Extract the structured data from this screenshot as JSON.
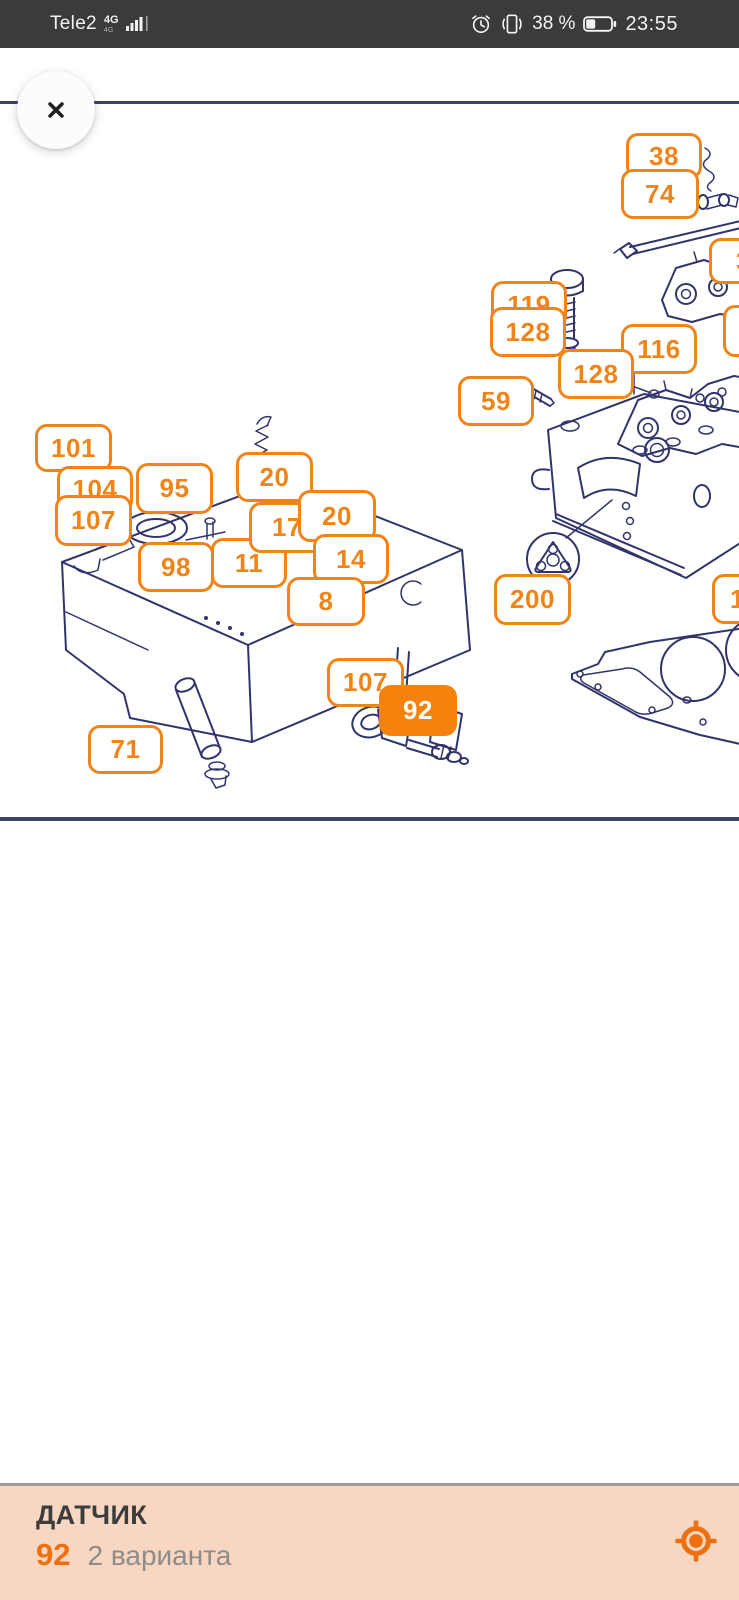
{
  "status_bar": {
    "carrier": "Tele2",
    "network": "4G",
    "network_sub": "4G",
    "battery_percent": "38 %",
    "battery_level": 0.38,
    "time": "23:55"
  },
  "diagram": {
    "accent": "#F08418",
    "highlight_fill": "#F5820D",
    "line_color": "#31346B",
    "labels": [
      {
        "text": "38",
        "x": 626,
        "y": 133,
        "w": 76,
        "h": 46
      },
      {
        "text": "74",
        "x": 621,
        "y": 169,
        "w": 78,
        "h": 50
      },
      {
        "text": "119",
        "x": 491,
        "y": 281,
        "w": 76,
        "h": 48
      },
      {
        "text": "128",
        "x": 490,
        "y": 307,
        "w": 76,
        "h": 50
      },
      {
        "text": "116",
        "x": 621,
        "y": 324,
        "w": 76,
        "h": 50
      },
      {
        "text": "128",
        "x": 558,
        "y": 349,
        "w": 76,
        "h": 50
      },
      {
        "text": "59",
        "x": 458,
        "y": 376,
        "w": 76,
        "h": 50
      },
      {
        "text": "101",
        "x": 35,
        "y": 424,
        "w": 77,
        "h": 48
      },
      {
        "text": "104",
        "x": 57,
        "y": 466,
        "w": 76,
        "h": 47
      },
      {
        "text": "107",
        "x": 55,
        "y": 495,
        "w": 77,
        "h": 51
      },
      {
        "text": "95",
        "x": 136,
        "y": 463,
        "w": 77,
        "h": 51
      },
      {
        "text": "20",
        "x": 236,
        "y": 452,
        "w": 77,
        "h": 50
      },
      {
        "text": "98",
        "x": 138,
        "y": 542,
        "w": 76,
        "h": 50
      },
      {
        "text": "11",
        "x": 211,
        "y": 538,
        "w": 76,
        "h": 50
      },
      {
        "text": "17",
        "x": 249,
        "y": 502,
        "w": 76,
        "h": 51
      },
      {
        "text": "20",
        "x": 298,
        "y": 490,
        "w": 78,
        "h": 52
      },
      {
        "text": "14",
        "x": 313,
        "y": 534,
        "w": 76,
        "h": 50
      },
      {
        "text": "8",
        "x": 287,
        "y": 577,
        "w": 78,
        "h": 49
      },
      {
        "text": "200",
        "x": 494,
        "y": 574,
        "w": 77,
        "h": 51
      },
      {
        "text": "107",
        "x": 327,
        "y": 658,
        "w": 77,
        "h": 49
      },
      {
        "text": "92",
        "x": 379,
        "y": 685,
        "w": 78,
        "h": 51,
        "highlighted": true
      },
      {
        "text": "71",
        "x": 88,
        "y": 725,
        "w": 75,
        "h": 49
      },
      {
        "text": "3",
        "x": 709,
        "y": 238,
        "w": 66,
        "h": 46,
        "clipped": true,
        "pad": 24
      },
      {
        "text": "",
        "x": 723,
        "y": 305,
        "w": 62,
        "h": 52,
        "clipped": true
      },
      {
        "text": "1",
        "x": 712,
        "y": 574,
        "w": 64,
        "h": 50,
        "clipped": true,
        "pad": 15
      }
    ]
  },
  "bottom_panel": {
    "title": "ДАТЧИК",
    "number": "92",
    "variants": "2 варианта",
    "background": "#F8D7C2",
    "accent": "#EE6F10"
  }
}
